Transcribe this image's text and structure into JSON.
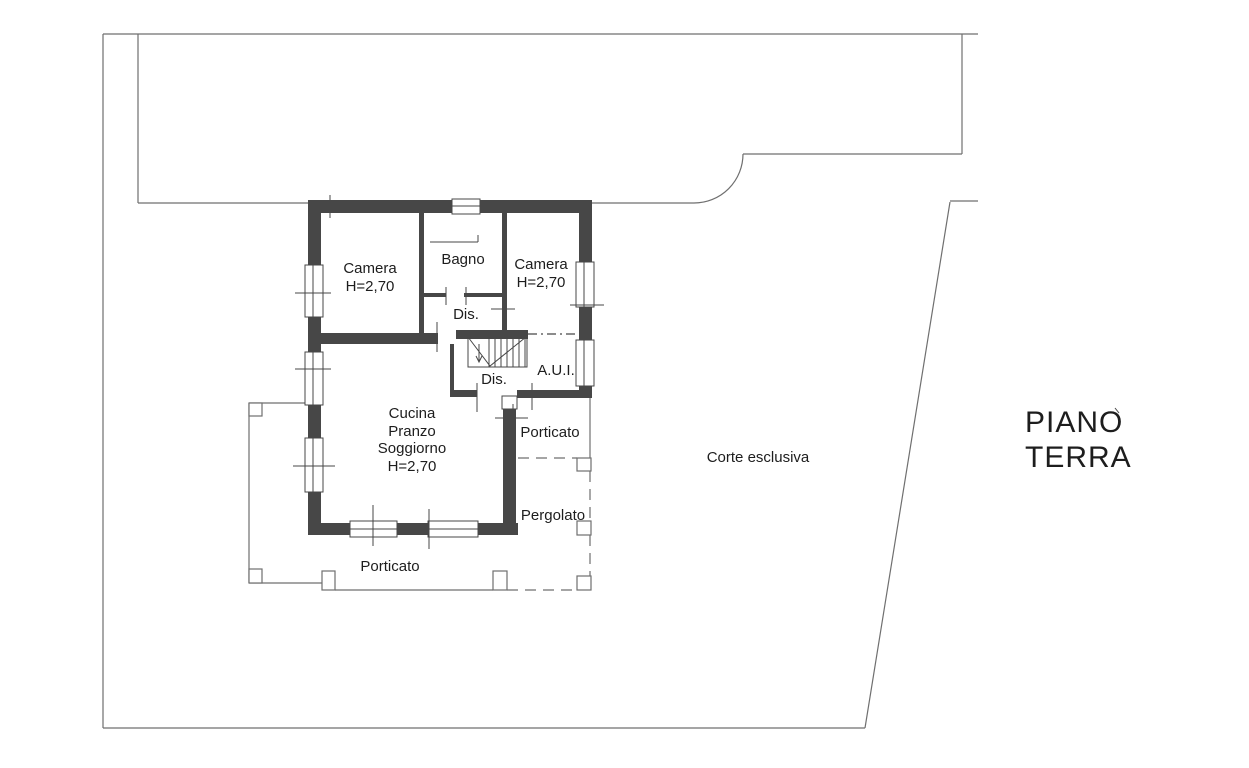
{
  "title": {
    "line1": "PIANO",
    "line2": "TERRA"
  },
  "rooms": {
    "camera_left": {
      "label": "Camera",
      "height": "H=2,70"
    },
    "bagno": {
      "label": "Bagno"
    },
    "camera_right": {
      "label": "Camera",
      "height": "H=2,70"
    },
    "dis_upper": {
      "label": "Dis."
    },
    "dis_lower": {
      "label": "Dis."
    },
    "aui": {
      "label": "A.U.I."
    },
    "cucina": {
      "lines": [
        "Cucina",
        "Pranzo",
        "Soggiorno",
        "H=2,70"
      ]
    },
    "porticato_east": {
      "label": "Porticato"
    },
    "pergolato": {
      "label": "Pergolato"
    },
    "porticato_south": {
      "label": "Porticato"
    },
    "corte_esclusiva": {
      "label": "Corte esclusiva"
    }
  },
  "colors": {
    "wall": "#474747",
    "line": "#6f6f6f",
    "text": "#1d1d1d",
    "background": "#ffffff"
  }
}
